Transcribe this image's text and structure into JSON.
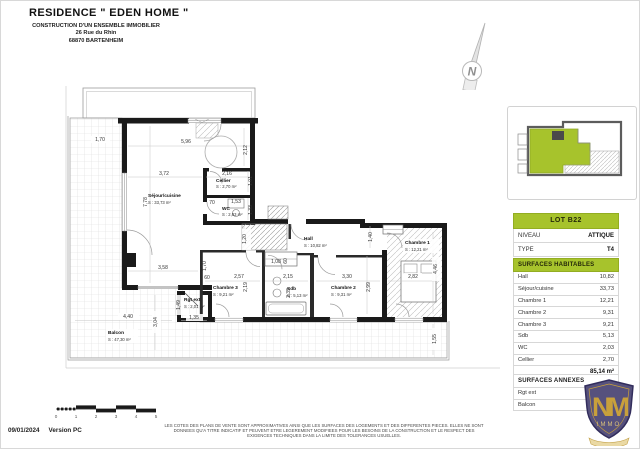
{
  "header": {
    "title": "RESIDENCE \" EDEN HOME \"",
    "line1": "CONSTRUCTION D'UN ENSEMBLE IMMOBILIER",
    "line2": "26 Rue du Rhin",
    "line3": "68870 BARTENHEIM"
  },
  "north": {
    "label": "N"
  },
  "plan": {
    "rooms": [
      {
        "name": "Séjour/cuisine",
        "area": "S : 33,73 m²"
      },
      {
        "name": "Cellier",
        "area": "S : 2,70 m²"
      },
      {
        "name": "WC",
        "area": "S : 2,03 m²"
      },
      {
        "name": "Hall",
        "area": "S : 10,82 m²"
      },
      {
        "name": "Chambre 3",
        "area": "S : 9,21 m²"
      },
      {
        "name": "Sdb",
        "area": "S : 5,13 m²"
      },
      {
        "name": "Chambre 2",
        "area": "S : 9,31 m²"
      },
      {
        "name": "Chambre 1",
        "area": "S : 12,21 m²"
      },
      {
        "name": "Rgt ext",
        "area": "S : 2,01 m²"
      },
      {
        "name": "Balcon",
        "area": "S : 47,30 m²"
      }
    ],
    "dims": [
      "1,70",
      "5,96",
      "2,12",
      "3,72",
      "2,16",
      "1,01",
      "7,78",
      "70",
      "1,53",
      "1,33",
      "3,58",
      "1,20",
      "1,08",
      "60",
      "1,40",
      "1,70",
      "60",
      "2,57",
      "2,15",
      "3,30",
      "2,82",
      "2,19",
      "2,39",
      "2,99",
      "4,46",
      "1,49",
      "1,35",
      "4,40",
      "3,04",
      "1,55"
    ]
  },
  "panel": {
    "lot": {
      "title": "LOT B22",
      "rows": [
        {
          "label": "NIVEAU",
          "value": "ATTIQUE"
        },
        {
          "label": "TYPE",
          "value": "T4"
        }
      ]
    },
    "surfaces_habitables": {
      "title": "SURFACES HABITABLES",
      "rows": [
        {
          "label": "Hall",
          "value": "10,82"
        },
        {
          "label": "Séjour/cuisine",
          "value": "33,73"
        },
        {
          "label": "Chambre 1",
          "value": "12,21"
        },
        {
          "label": "Chambre 2",
          "value": "9,31"
        },
        {
          "label": "Chambre 3",
          "value": "9,21"
        },
        {
          "label": "Sdb",
          "value": "5,13"
        },
        {
          "label": "WC",
          "value": "2,03"
        },
        {
          "label": "Cellier",
          "value": "2,70"
        }
      ],
      "total": "85,14 m²"
    },
    "surfaces_annexes": {
      "title": "SURFACES ANNEXES",
      "rows": [
        {
          "label": "Rgt ext",
          "value": ""
        },
        {
          "label": "Balcon",
          "value": ""
        }
      ]
    }
  },
  "logo": {
    "monogram": "NM",
    "text": "IMMO"
  },
  "footer": {
    "date": "09/01/2024",
    "version": "Version PC",
    "scale_ticks": [
      "0",
      "1",
      "2",
      "3",
      "4",
      "5"
    ],
    "disclaimer_lines": [
      "LES COTES DES PLANS DE VENTE SONT APPROXIMATIVES AINSI QUE LES SURFACES DES LOGEMENTS ET DES DIFFERENTES PIECES. ELLES NE SONT",
      "DONNEES QU'A TITRE INDICATIF ET PEUVENT ETRE LEGEREMENT MODIFIEES POUR LES BESOINS DE LA CONSTRUCTION ET LE RESPECT DES",
      "EXIGENCES TECHNIQUES DANS LA LIMITE DES TOLERANCES USUELLES."
    ]
  },
  "colors": {
    "accent_green": "#a7c32c",
    "shield_purple": "#56517d",
    "gold": "#c8a03c"
  }
}
